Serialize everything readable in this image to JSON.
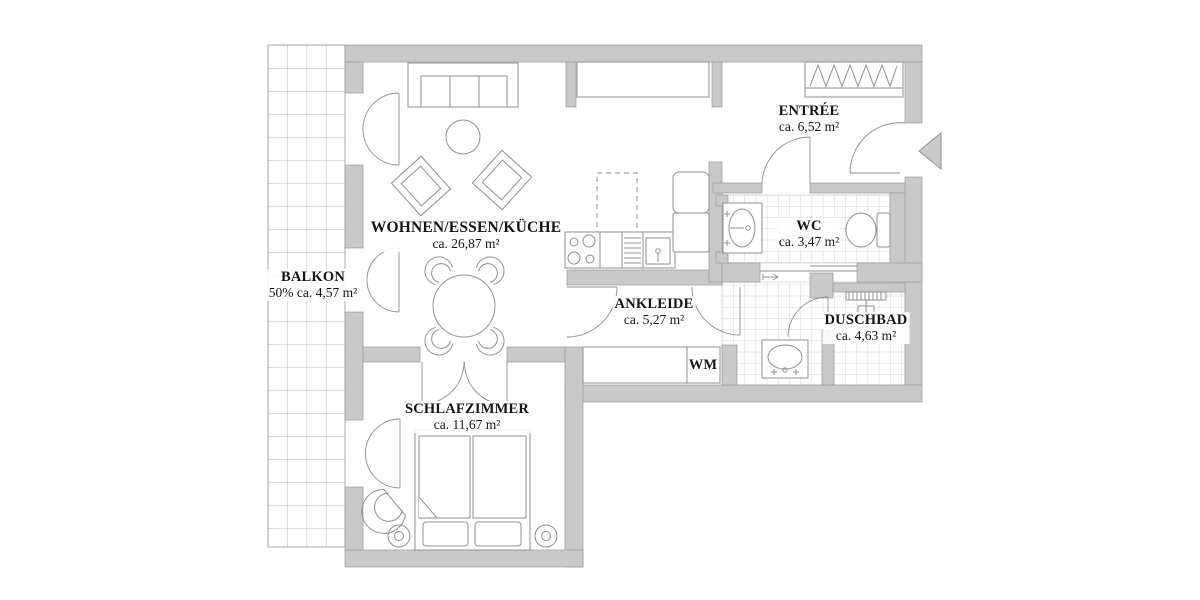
{
  "plan": {
    "title": "apartment-floor-plan",
    "rooms": [
      {
        "id": "balkon",
        "name": "BALKON",
        "area": "50% ca. 4,57 m²"
      },
      {
        "id": "wohnen",
        "name": "WOHNEN/ESSEN/KÜCHE",
        "area": "ca. 26,87 m²"
      },
      {
        "id": "entree",
        "name": "ENTRÉE",
        "area": "ca. 6,52 m²"
      },
      {
        "id": "wc",
        "name": "WC",
        "area": "ca. 3,47 m²"
      },
      {
        "id": "ankleide",
        "name": "ANKLEIDE",
        "area": "ca. 5,27 m²"
      },
      {
        "id": "duschbad",
        "name": "DUSCHBAD",
        "area": "ca. 4,63 m²"
      },
      {
        "id": "schlafzimmer",
        "name": "SCHLAFZIMMER",
        "area": "ca. 11,67 m²"
      }
    ],
    "labels": {
      "wm": "WM"
    },
    "colors": {
      "wall": "#c9c9c9",
      "wall_edge": "#999999",
      "furniture_line": "#8f8f8f",
      "tile_line": "#d2d2d2",
      "balcony_grid_line": "#b5b5b5",
      "text": "#141414",
      "background": "#ffffff"
    }
  }
}
